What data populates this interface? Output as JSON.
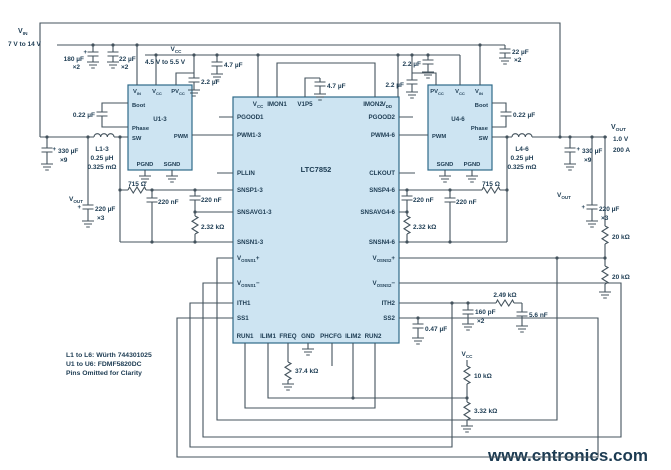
{
  "ic": {
    "name": "LTC7852"
  },
  "power_stages": {
    "left": "U1-3",
    "right": "U4-6"
  },
  "input": {
    "label": "VIN",
    "range": "7 V to 14 V"
  },
  "bias": {
    "label": "VCC",
    "range": "4.5 V to 5.5 V"
  },
  "output": {
    "label": "VOUT",
    "voltage": "1.0 V",
    "current": "200 A"
  },
  "inductors": {
    "left": "L1-3",
    "right": "L4-6",
    "value": "0.25 µH",
    "dcr": "0.325 mΩ"
  },
  "notes": [
    "L1 to L6: Würth 744301025",
    "U1 to U6: FDMF5820DC",
    "Pins Omitted for Clarity"
  ],
  "watermark": "www.cntronics.com",
  "colors": {
    "wire": "#44535d",
    "text": "#1c3b52",
    "block_fill": "#cde4f2",
    "block_stroke": "#2e6a89",
    "watermark": "#b5dfae"
  },
  "labels": [
    {
      "n": "vin-label",
      "p": [
        [
          "V",
          0
        ],
        [
          "IN",
          1
        ]
      ],
      "x": 18,
      "y": 33,
      "s": 7
    },
    {
      "n": "vin-range",
      "t": "7 V to 14 V",
      "x": 8,
      "y": 46
    },
    {
      "n": "cap-180uF-value",
      "t": "180 µF",
      "x": 84,
      "y": 61,
      "a": "end"
    },
    {
      "n": "cap-180uF-plus",
      "t": "+",
      "x": 87,
      "y": 54,
      "a": "end",
      "s": 6
    },
    {
      "n": "cap-180uF-qty",
      "t": "×2",
      "x": 80,
      "y": 69,
      "a": "end"
    },
    {
      "n": "cap-22uF-left-value",
      "t": "22 µF",
      "x": 119,
      "y": 61
    },
    {
      "n": "cap-22uF-left-qty",
      "t": "×2",
      "x": 121,
      "y": 69
    },
    {
      "n": "vcc-label",
      "p": [
        [
          "V",
          0
        ],
        [
          "CC",
          1
        ]
      ],
      "x": 176,
      "y": 51,
      "a": "middle"
    },
    {
      "n": "vcc-range",
      "t": "4.5 V to 5.5 V",
      "x": 145,
      "y": 64
    },
    {
      "n": "cap-4p7uF-left",
      "t": "4.7 µF",
      "x": 224,
      "y": 67
    },
    {
      "n": "cap-2p2uF-left",
      "t": "2.2 µF",
      "x": 201,
      "y": 84
    },
    {
      "n": "cap-0p22uF-left",
      "t": "0.22 µF",
      "x": 95,
      "y": 117,
      "a": "end"
    },
    {
      "n": "inductor-left-name",
      "t": "L1-3",
      "x": 102,
      "y": 151,
      "a": "middle"
    },
    {
      "n": "inductor-left-value",
      "t": "0.25 µH",
      "x": 102,
      "y": 160,
      "a": "middle"
    },
    {
      "n": "inductor-left-dcr",
      "t": "0.325 mΩ",
      "x": 102,
      "y": 169,
      "a": "middle"
    },
    {
      "n": "cap-330uF-left-plus",
      "t": "+",
      "x": 56,
      "y": 151,
      "a": "end",
      "s": 6
    },
    {
      "n": "cap-330uF-left-value",
      "t": "330 µF",
      "x": 58,
      "y": 153
    },
    {
      "n": "cap-330uF-left-qty",
      "t": "×9",
      "x": 60,
      "y": 162
    },
    {
      "n": "vout-left-label",
      "p": [
        [
          "V",
          0
        ],
        [
          "OUT",
          1
        ]
      ],
      "x": 83,
      "y": 201,
      "a": "end"
    },
    {
      "n": "cap-220uF-left-plus",
      "t": "+",
      "x": 81,
      "y": 209,
      "a": "end",
      "s": 6
    },
    {
      "n": "cap-220uF-left-value",
      "t": "220 µF",
      "x": 95,
      "y": 211
    },
    {
      "n": "cap-220uF-left-qty",
      "t": "×3",
      "x": 97,
      "y": 220
    },
    {
      "n": "res-715-left",
      "t": "715 Ω",
      "x": 137,
      "y": 186,
      "a": "middle"
    },
    {
      "n": "cap-220nF-left-1",
      "t": "220 nF",
      "x": 158,
      "y": 204
    },
    {
      "n": "cap-220nF-left-2",
      "t": "220 nF",
      "x": 201,
      "y": 202
    },
    {
      "n": "res-2p32k-left",
      "t": "2.32 kΩ",
      "x": 201,
      "y": 229
    },
    {
      "n": "u1-pin-vin",
      "p": [
        [
          "V",
          0
        ],
        [
          "IN",
          1
        ]
      ],
      "x": 137,
      "y": 93,
      "a": "middle",
      "s": 5.8
    },
    {
      "n": "u1-pin-vcc",
      "p": [
        [
          "V",
          0
        ],
        [
          "CC",
          1
        ]
      ],
      "x": 157,
      "y": 93,
      "a": "middle",
      "s": 5.8
    },
    {
      "n": "u1-pin-pvcc",
      "p": [
        [
          "PV",
          0
        ],
        [
          "CC",
          1
        ]
      ],
      "x": 178,
      "y": 93,
      "a": "middle",
      "s": 5.8
    },
    {
      "n": "u1-pin-boot",
      "t": "Boot",
      "x": 132,
      "y": 107,
      "s": 5.8
    },
    {
      "n": "u1-name",
      "t": "U1-3",
      "x": 160,
      "y": 121,
      "a": "middle",
      "s": 6.2
    },
    {
      "n": "u1-pin-phase",
      "t": "Phase",
      "x": 132,
      "y": 130,
      "s": 5.8
    },
    {
      "n": "u1-pin-sw",
      "t": "SW",
      "x": 132,
      "y": 140,
      "s": 5.8
    },
    {
      "n": "u1-pin-pwm",
      "t": "PWM",
      "x": 188,
      "y": 138,
      "a": "end",
      "s": 5.8
    },
    {
      "n": "u1-pin-pgnd",
      "t": "PGND",
      "x": 145,
      "y": 166,
      "a": "middle",
      "s": 5.8
    },
    {
      "n": "u1-pin-sgnd",
      "t": "SGND",
      "x": 172,
      "y": 166,
      "a": "middle",
      "s": 5.8
    },
    {
      "n": "cap-4p7uF-center",
      "t": "4.7 µF",
      "x": 327,
      "y": 88
    },
    {
      "n": "ic-pin-vcc",
      "p": [
        [
          "V",
          0
        ],
        [
          "CC",
          1
        ]
      ],
      "x": 258,
      "y": 106,
      "a": "middle",
      "s": 6.2
    },
    {
      "n": "ic-pin-imon1",
      "t": "IMON1",
      "x": 277,
      "y": 106,
      "a": "middle",
      "s": 6.2
    },
    {
      "n": "ic-pin-v1p5",
      "t": "V1P5",
      "x": 305,
      "y": 106,
      "a": "middle",
      "s": 6.2
    },
    {
      "n": "ic-pin-imon2",
      "t": "IMON2",
      "x": 373,
      "y": 106,
      "a": "middle",
      "s": 6.2
    },
    {
      "n": "ic-pin-vdd",
      "p": [
        [
          "V",
          0
        ],
        [
          "DD",
          1
        ]
      ],
      "x": 392,
      "y": 106,
      "a": "end",
      "s": 6.2
    },
    {
      "n": "ic-pin-pgood1",
      "t": "PGOOD1",
      "x": 237,
      "y": 119,
      "s": 6.2
    },
    {
      "n": "ic-pin-pwm1-3",
      "t": "PWM1-3",
      "x": 237,
      "y": 137,
      "s": 6.2
    },
    {
      "n": "ic-pin-pllin",
      "t": "PLLIN",
      "x": 237,
      "y": 175,
      "s": 6.2
    },
    {
      "n": "ic-pin-snsp1-3",
      "t": "SNSP1-3",
      "x": 237,
      "y": 192,
      "s": 6.2
    },
    {
      "n": "ic-pin-snsavg1-3",
      "t": "SNSAVG1-3",
      "x": 237,
      "y": 214,
      "s": 6.2
    },
    {
      "n": "ic-pin-snsn1-3",
      "t": "SNSN1-3",
      "x": 237,
      "y": 244,
      "s": 6.2
    },
    {
      "n": "ic-pin-vosns1p",
      "p": [
        [
          "V",
          0
        ],
        [
          "OSNS1",
          1
        ],
        [
          "+",
          0
        ]
      ],
      "x": 237,
      "y": 260,
      "s": 6.2
    },
    {
      "n": "ic-pin-vosns1n",
      "p": [
        [
          "V",
          0
        ],
        [
          "OSNS1",
          1
        ],
        [
          "−",
          0
        ]
      ],
      "x": 237,
      "y": 285,
      "s": 6.2
    },
    {
      "n": "ic-pin-ith1",
      "t": "ITH1",
      "x": 237,
      "y": 305,
      "s": 6.2
    },
    {
      "n": "ic-pin-ss1",
      "t": "SS1",
      "x": 237,
      "y": 320,
      "s": 6.2
    },
    {
      "n": "ic-pin-pgood2",
      "t": "PGOOD2",
      "x": 395,
      "y": 119,
      "a": "end",
      "s": 6.2
    },
    {
      "n": "ic-pin-pwm4-6",
      "t": "PWM4-6",
      "x": 395,
      "y": 137,
      "a": "end",
      "s": 6.2
    },
    {
      "n": "ic-pin-clkout",
      "t": "CLKOUT",
      "x": 395,
      "y": 175,
      "a": "end",
      "s": 6.2
    },
    {
      "n": "ic-pin-snsp4-6",
      "t": "SNSP4-6",
      "x": 395,
      "y": 192,
      "a": "end",
      "s": 6.2
    },
    {
      "n": "ic-pin-snsavg4-6",
      "t": "SNSAVG4-6",
      "x": 395,
      "y": 214,
      "a": "end",
      "s": 6.2
    },
    {
      "n": "ic-pin-snsn4-6",
      "t": "SNSN4-6",
      "x": 395,
      "y": 244,
      "a": "end",
      "s": 6.2
    },
    {
      "n": "ic-pin-vosns2p",
      "p": [
        [
          "V",
          0
        ],
        [
          "OSNS2",
          1
        ],
        [
          "+",
          0
        ]
      ],
      "x": 395,
      "y": 260,
      "a": "end",
      "s": 6.2
    },
    {
      "n": "ic-pin-vosns2n",
      "p": [
        [
          "V",
          0
        ],
        [
          "OSNS2",
          1
        ],
        [
          "−",
          0
        ]
      ],
      "x": 395,
      "y": 285,
      "a": "end",
      "s": 6.2
    },
    {
      "n": "ic-pin-ith2",
      "t": "ITH2",
      "x": 395,
      "y": 305,
      "a": "end",
      "s": 6.2
    },
    {
      "n": "ic-pin-ss2",
      "t": "SS2",
      "x": 395,
      "y": 320,
      "a": "end",
      "s": 6.2
    },
    {
      "n": "ic-pin-run1",
      "t": "RUN1",
      "x": 245,
      "y": 338,
      "a": "middle",
      "s": 6.2
    },
    {
      "n": "ic-pin-ilim1",
      "t": "ILIM1",
      "x": 268,
      "y": 338,
      "a": "middle",
      "s": 6.2
    },
    {
      "n": "ic-pin-freq",
      "t": "FREQ",
      "x": 288,
      "y": 338,
      "a": "middle",
      "s": 6.2
    },
    {
      "n": "ic-pin-gnd",
      "t": "GND",
      "x": 308,
      "y": 338,
      "a": "middle",
      "s": 6.2
    },
    {
      "n": "ic-pin-phcfg",
      "t": "PHCFG",
      "x": 331,
      "y": 338,
      "a": "middle",
      "s": 6.2
    },
    {
      "n": "ic-pin-ilim2",
      "t": "ILIM2",
      "x": 353,
      "y": 338,
      "a": "middle",
      "s": 6.2
    },
    {
      "n": "ic-pin-run2",
      "t": "RUN2",
      "x": 373,
      "y": 338,
      "a": "middle",
      "s": 6.2
    },
    {
      "n": "ic-part-number",
      "t": "LTC7852",
      "x": 316,
      "y": 172,
      "a": "middle",
      "s": 7.5
    },
    {
      "n": "u4-pin-pvcc",
      "p": [
        [
          "PV",
          0
        ],
        [
          "CC",
          1
        ]
      ],
      "x": 437,
      "y": 93,
      "a": "middle",
      "s": 5.8
    },
    {
      "n": "u4-pin-vcc",
      "p": [
        [
          "V",
          0
        ],
        [
          "CC",
          1
        ]
      ],
      "x": 460,
      "y": 93,
      "a": "middle",
      "s": 5.8
    },
    {
      "n": "u4-pin-vin",
      "p": [
        [
          "V",
          0
        ],
        [
          "IN",
          1
        ]
      ],
      "x": 479,
      "y": 93,
      "a": "middle",
      "s": 5.8
    },
    {
      "n": "u4-pin-boot",
      "t": "Boot",
      "x": 488,
      "y": 107,
      "a": "end",
      "s": 5.8
    },
    {
      "n": "u4-name",
      "t": "U4-6",
      "x": 458,
      "y": 121,
      "a": "middle",
      "s": 6.2
    },
    {
      "n": "u4-pin-phase",
      "t": "Phase",
      "x": 488,
      "y": 130,
      "a": "end",
      "s": 5.8
    },
    {
      "n": "u4-pin-sw",
      "t": "SW",
      "x": 488,
      "y": 140,
      "a": "end",
      "s": 5.8
    },
    {
      "n": "u4-pin-pwm",
      "t": "PWM",
      "x": 432,
      "y": 138,
      "s": 5.8
    },
    {
      "n": "u4-pin-sgnd",
      "t": "SGND",
      "x": 445,
      "y": 166,
      "a": "middle",
      "s": 5.8
    },
    {
      "n": "u4-pin-pgnd",
      "t": "PGND",
      "x": 472,
      "y": 166,
      "a": "middle",
      "s": 5.8
    },
    {
      "n": "cap-2p2uF-right-upper",
      "t": "2.2 µF",
      "x": 421,
      "y": 66,
      "a": "end"
    },
    {
      "n": "cap-2p2uF-right-lower",
      "t": "2.2 µF",
      "x": 404,
      "y": 87,
      "a": "end"
    },
    {
      "n": "cap-22uF-right-value",
      "t": "22 µF",
      "x": 512,
      "y": 54
    },
    {
      "n": "cap-22uF-right-qty",
      "t": "×2",
      "x": 514,
      "y": 62
    },
    {
      "n": "cap-0p22uF-right",
      "t": "0.22 µF",
      "x": 513,
      "y": 117
    },
    {
      "n": "inductor-right-name",
      "t": "L4-6",
      "x": 522,
      "y": 151,
      "a": "middle"
    },
    {
      "n": "inductor-right-value",
      "t": "0.25 µH",
      "x": 522,
      "y": 160,
      "a": "middle"
    },
    {
      "n": "inductor-right-dcr",
      "t": "0.325 mΩ",
      "x": 522,
      "y": 169,
      "a": "middle"
    },
    {
      "n": "cap-330uF-right-plus",
      "t": "+",
      "x": 580,
      "y": 151,
      "a": "end",
      "s": 6
    },
    {
      "n": "cap-330uF-right-value",
      "t": "330 µF",
      "x": 582,
      "y": 153
    },
    {
      "n": "cap-330uF-right-qty",
      "t": "×9",
      "x": 584,
      "y": 162
    },
    {
      "n": "vout-main-label",
      "p": [
        [
          "V",
          0
        ],
        [
          "OUT",
          1
        ]
      ],
      "x": 611,
      "y": 129,
      "s": 7
    },
    {
      "n": "vout-main-voltage",
      "t": "1.0 V",
      "x": 613,
      "y": 141
    },
    {
      "n": "vout-main-current",
      "t": "200 A",
      "x": 613,
      "y": 152
    },
    {
      "n": "vout-right-label",
      "p": [
        [
          "V",
          0
        ],
        [
          "OUT",
          1
        ]
      ],
      "x": 557,
      "y": 197
    },
    {
      "n": "cap-220uF-right-plus",
      "t": "+",
      "x": 585,
      "y": 209,
      "a": "end",
      "s": 6
    },
    {
      "n": "cap-220uF-right-value",
      "t": "220 µF",
      "x": 599,
      "y": 211
    },
    {
      "n": "cap-220uF-right-qty",
      "t": "×3",
      "x": 601,
      "y": 220
    },
    {
      "n": "res-715-right",
      "t": "715 Ω",
      "x": 491,
      "y": 186,
      "a": "middle"
    },
    {
      "n": "cap-220nF-right-1",
      "t": "220 nF",
      "x": 456,
      "y": 204
    },
    {
      "n": "cap-220nF-right-2",
      "t": "220 nF",
      "x": 413,
      "y": 202
    },
    {
      "n": "res-2p32k-right",
      "t": "2.32 kΩ",
      "x": 413,
      "y": 229
    },
    {
      "n": "res-20k-upper",
      "t": "20 kΩ",
      "x": 612,
      "y": 239
    },
    {
      "n": "res-20k-lower",
      "t": "20 kΩ",
      "x": 612,
      "y": 279
    },
    {
      "n": "res-2p49k",
      "t": "2.49 kΩ",
      "x": 505,
      "y": 297,
      "a": "middle"
    },
    {
      "n": "cap-160pF-value",
      "t": "160 pF",
      "x": 475,
      "y": 314
    },
    {
      "n": "cap-160pF-qty",
      "t": "×2",
      "x": 477,
      "y": 323
    },
    {
      "n": "cap-5p6nF",
      "t": "5.6 nF",
      "x": 529,
      "y": 317
    },
    {
      "n": "cap-0p47uF",
      "t": "0.47 µF",
      "x": 425,
      "y": 331
    },
    {
      "n": "vcc-bottom-label",
      "p": [
        [
          "V",
          0
        ],
        [
          "CC",
          1
        ]
      ],
      "x": 467,
      "y": 356,
      "a": "middle"
    },
    {
      "n": "res-10k",
      "t": "10 kΩ",
      "x": 474,
      "y": 378
    },
    {
      "n": "res-3p32k",
      "t": "3.32 kΩ",
      "x": 474,
      "y": 413
    },
    {
      "n": "res-37p4k",
      "t": "37.4 kΩ",
      "x": 295,
      "y": 373
    },
    {
      "n": "note-line-1",
      "t": "L1 to L6: Würth 744301025",
      "x": 66,
      "y": 357,
      "s": 6.8
    },
    {
      "n": "note-line-2",
      "t": "U1 to U6: FDMF5820DC",
      "x": 66,
      "y": 366,
      "s": 6.8
    },
    {
      "n": "note-line-3",
      "t": "Pins Omitted for Clarity",
      "x": 66,
      "y": 375,
      "s": 6.8
    },
    {
      "n": "watermark",
      "t": "www.cntronics.com",
      "x": 488,
      "y": 461,
      "s": 17,
      "f": "#b5dfae",
      "l": "back"
    }
  ]
}
